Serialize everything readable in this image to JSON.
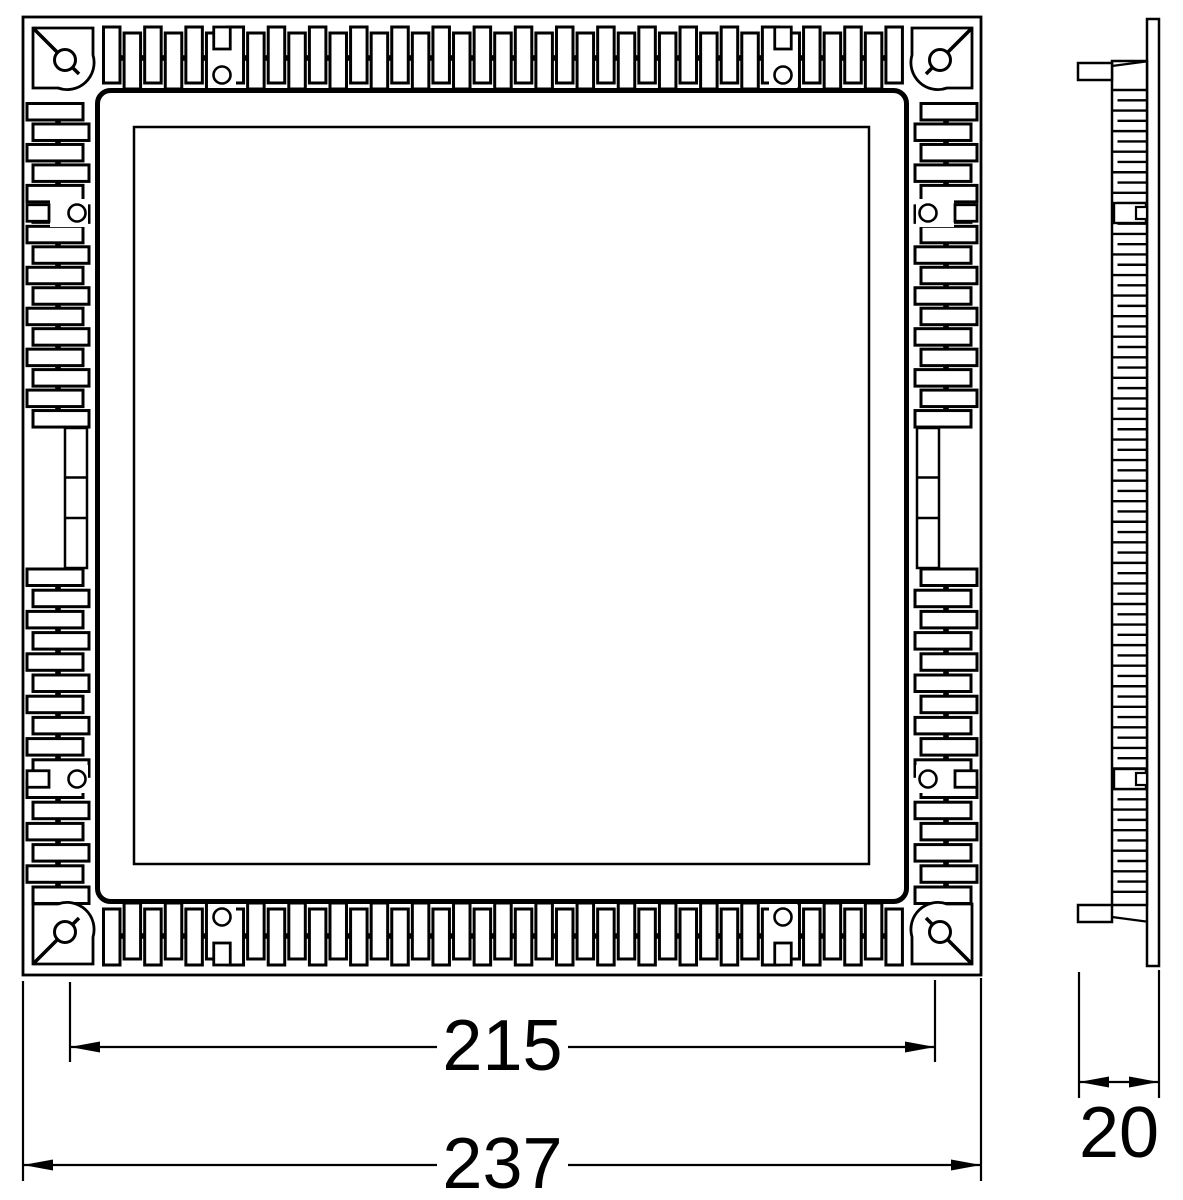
{
  "page": {
    "background": "#ffffff",
    "line_color": "#000000"
  },
  "drawing": {
    "type": "dimensioned-technical-drawing",
    "views": [
      {
        "name": "front-view"
      },
      {
        "name": "side-view"
      }
    ],
    "dimensions": {
      "cutout": {
        "value": "215"
      },
      "overall": {
        "value": "237"
      },
      "depth": {
        "value": "20"
      }
    }
  }
}
